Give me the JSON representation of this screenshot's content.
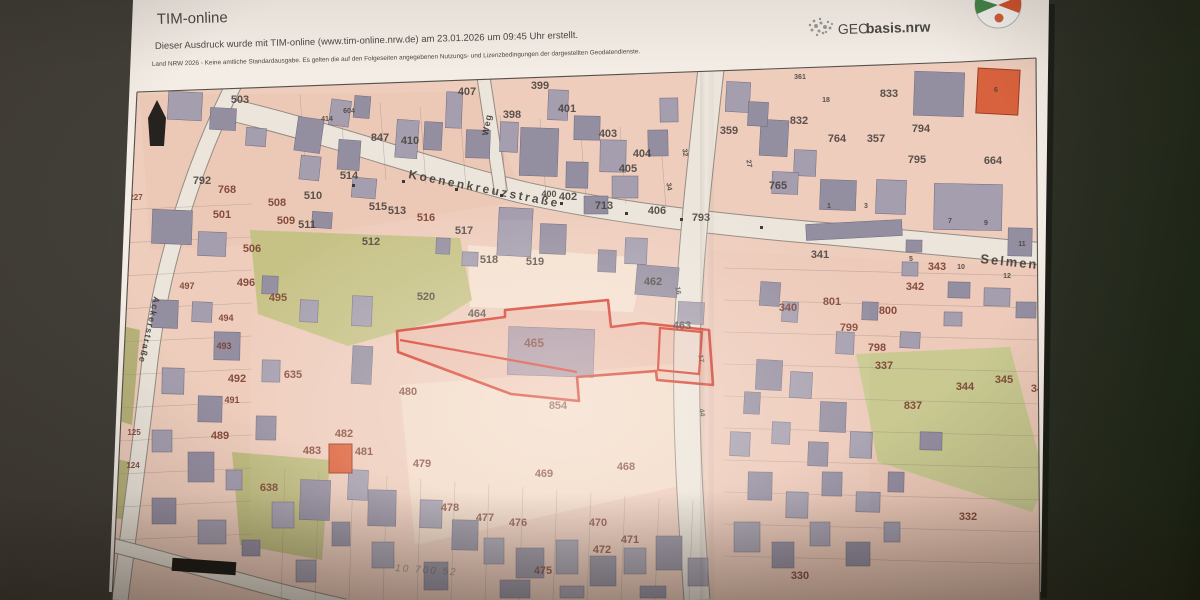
{
  "header": {
    "app_title": "TIM-online",
    "print_note": "Dieser Ausdruck wurde mit TIM-online (www.tim-online.nrw.de) am 23.01.2026 um 09:45 Uhr erstellt.",
    "license_note": "Land NRW 2026 - Keine amtliche Standardausgabe. Es gelten die auf den Folgeseiten angegebenen Nutzungs- und Lizenzbedingungen der dargestellten Geodatendienste.",
    "brand_geo": "GEO",
    "brand_bold": "basis.nrw"
  },
  "map": {
    "type": "cadastral",
    "highlight_parcel": "465",
    "highlight_color": "#e03524",
    "paper_color": "#f0ccba",
    "annotation": {
      "text": "10 700 52",
      "x": 395,
      "y": 571,
      "rot": 4
    },
    "streets": [
      {
        "name": "Koenenkreuzstraße",
        "x": 408,
        "y": 178,
        "rot": 11,
        "size": 12,
        "ls": 2.5
      },
      {
        "name": "Selmen",
        "x": 980,
        "y": 263,
        "rot": 6,
        "size": 13,
        "ls": 2
      },
      {
        "name": "Weg",
        "x": 488,
        "y": 136,
        "rot": -80,
        "size": 9,
        "ls": 1
      },
      {
        "name": "Ackerstraße",
        "x": 154,
        "y": 296,
        "rot": 103,
        "size": 9,
        "ls": 1.5
      }
    ],
    "parcels": [
      {
        "n": "503",
        "x": 240,
        "y": 103,
        "c": "g"
      },
      {
        "n": "407",
        "x": 467,
        "y": 95,
        "c": "g"
      },
      {
        "n": "399",
        "x": 540,
        "y": 89,
        "c": "g"
      },
      {
        "n": "398",
        "x": 512,
        "y": 118,
        "c": "g"
      },
      {
        "n": "401",
        "x": 567,
        "y": 112,
        "c": "g"
      },
      {
        "n": "403",
        "x": 608,
        "y": 137,
        "c": "g"
      },
      {
        "n": "404",
        "x": 642,
        "y": 157,
        "c": "g"
      },
      {
        "n": "405",
        "x": 628,
        "y": 172,
        "c": "g"
      },
      {
        "n": "402",
        "x": 568,
        "y": 200,
        "c": "g"
      },
      {
        "n": "400",
        "x": 549,
        "y": 197,
        "c": "g",
        "s": 9
      },
      {
        "n": "713",
        "x": 604,
        "y": 209,
        "c": "g"
      },
      {
        "n": "406",
        "x": 657,
        "y": 214,
        "c": "g"
      },
      {
        "n": "359",
        "x": 729,
        "y": 134,
        "c": "g"
      },
      {
        "n": "793",
        "x": 701,
        "y": 221,
        "c": "g"
      },
      {
        "n": "765",
        "x": 778,
        "y": 189,
        "c": "g"
      },
      {
        "n": "341",
        "x": 820,
        "y": 258,
        "c": "g"
      },
      {
        "n": "361",
        "x": 800,
        "y": 79,
        "c": "g",
        "s": 7
      },
      {
        "n": "833",
        "x": 889,
        "y": 97,
        "c": "g"
      },
      {
        "n": "832",
        "x": 799,
        "y": 124,
        "c": "g"
      },
      {
        "n": "764",
        "x": 837,
        "y": 142,
        "c": "g"
      },
      {
        "n": "357",
        "x": 876,
        "y": 142,
        "c": "g"
      },
      {
        "n": "794",
        "x": 921,
        "y": 132,
        "c": "g"
      },
      {
        "n": "795",
        "x": 917,
        "y": 163,
        "c": "g"
      },
      {
        "n": "664",
        "x": 993,
        "y": 164,
        "c": "g"
      },
      {
        "n": "343",
        "x": 937,
        "y": 270,
        "c": "m"
      },
      {
        "n": "342",
        "x": 915,
        "y": 290,
        "c": "m"
      },
      {
        "n": "801",
        "x": 832,
        "y": 305,
        "c": "m"
      },
      {
        "n": "800",
        "x": 888,
        "y": 314,
        "c": "m"
      },
      {
        "n": "799",
        "x": 849,
        "y": 331,
        "c": "m"
      },
      {
        "n": "798",
        "x": 877,
        "y": 351,
        "c": "m"
      },
      {
        "n": "337",
        "x": 884,
        "y": 369,
        "c": "m"
      },
      {
        "n": "340",
        "x": 788,
        "y": 311,
        "c": "m"
      },
      {
        "n": "344",
        "x": 965,
        "y": 390,
        "c": "m"
      },
      {
        "n": "345",
        "x": 1004,
        "y": 383,
        "c": "m"
      },
      {
        "n": "34",
        "x": 1037,
        "y": 392,
        "c": "m"
      },
      {
        "n": "837",
        "x": 913,
        "y": 409,
        "c": "m"
      },
      {
        "n": "332",
        "x": 968,
        "y": 520,
        "c": "m"
      },
      {
        "n": "330",
        "x": 800,
        "y": 579,
        "c": "m"
      },
      {
        "n": "847",
        "x": 380,
        "y": 141,
        "c": "g"
      },
      {
        "n": "410",
        "x": 410,
        "y": 144,
        "c": "g"
      },
      {
        "n": "792",
        "x": 202,
        "y": 184,
        "c": "g"
      },
      {
        "n": "768",
        "x": 227,
        "y": 193,
        "c": "m"
      },
      {
        "n": "508",
        "x": 277,
        "y": 206,
        "c": "m"
      },
      {
        "n": "509",
        "x": 286,
        "y": 224,
        "c": "m"
      },
      {
        "n": "510",
        "x": 313,
        "y": 199,
        "c": "g"
      },
      {
        "n": "511",
        "x": 307,
        "y": 228,
        "c": "g"
      },
      {
        "n": "501",
        "x": 222,
        "y": 218,
        "c": "m"
      },
      {
        "n": "506",
        "x": 252,
        "y": 252,
        "c": "m"
      },
      {
        "n": "514",
        "x": 349,
        "y": 179,
        "c": "g"
      },
      {
        "n": "515",
        "x": 378,
        "y": 210,
        "c": "g"
      },
      {
        "n": "513",
        "x": 397,
        "y": 214,
        "c": "g"
      },
      {
        "n": "516",
        "x": 426,
        "y": 221,
        "c": "m"
      },
      {
        "n": "517",
        "x": 464,
        "y": 234,
        "c": "g"
      },
      {
        "n": "512",
        "x": 371,
        "y": 245,
        "c": "g"
      },
      {
        "n": "518",
        "x": 489,
        "y": 263,
        "c": "g"
      },
      {
        "n": "519",
        "x": 535,
        "y": 265,
        "c": "g"
      },
      {
        "n": "520",
        "x": 426,
        "y": 300,
        "c": "g"
      },
      {
        "n": "464",
        "x": 477,
        "y": 317,
        "c": "g"
      },
      {
        "n": "465",
        "x": 534,
        "y": 347,
        "c": "m",
        "s": 12
      },
      {
        "n": "462",
        "x": 653,
        "y": 285,
        "c": "g"
      },
      {
        "n": "463",
        "x": 682,
        "y": 329,
        "c": "g"
      },
      {
        "n": "496",
        "x": 246,
        "y": 286,
        "c": "m"
      },
      {
        "n": "497",
        "x": 187,
        "y": 289,
        "c": "m",
        "s": 9
      },
      {
        "n": "495",
        "x": 278,
        "y": 301,
        "c": "m"
      },
      {
        "n": "494",
        "x": 226,
        "y": 321,
        "c": "m",
        "s": 9
      },
      {
        "n": "493",
        "x": 224,
        "y": 349,
        "c": "m",
        "s": 9
      },
      {
        "n": "492",
        "x": 237,
        "y": 382,
        "c": "m"
      },
      {
        "n": "491",
        "x": 232,
        "y": 403,
        "c": "m",
        "s": 9
      },
      {
        "n": "635",
        "x": 293,
        "y": 378,
        "c": "m"
      },
      {
        "n": "489",
        "x": 220,
        "y": 439,
        "c": "m"
      },
      {
        "n": "638",
        "x": 269,
        "y": 491,
        "c": "m"
      },
      {
        "n": "227",
        "x": 136,
        "y": 200,
        "c": "m",
        "s": 8
      },
      {
        "n": "125",
        "x": 134,
        "y": 435,
        "c": "m",
        "s": 8
      },
      {
        "n": "124",
        "x": 133,
        "y": 468,
        "c": "m",
        "s": 8
      },
      {
        "n": "480",
        "x": 408,
        "y": 395,
        "c": "m"
      },
      {
        "n": "854",
        "x": 558,
        "y": 409,
        "c": "m"
      },
      {
        "n": "479",
        "x": 422,
        "y": 467,
        "c": "m"
      },
      {
        "n": "482",
        "x": 344,
        "y": 437,
        "c": "m"
      },
      {
        "n": "483",
        "x": 312,
        "y": 454,
        "c": "m"
      },
      {
        "n": "481",
        "x": 364,
        "y": 455,
        "c": "m"
      },
      {
        "n": "469",
        "x": 544,
        "y": 477,
        "c": "m"
      },
      {
        "n": "468",
        "x": 626,
        "y": 470,
        "c": "m"
      },
      {
        "n": "478",
        "x": 450,
        "y": 511,
        "c": "m"
      },
      {
        "n": "477",
        "x": 485,
        "y": 521,
        "c": "m"
      },
      {
        "n": "476",
        "x": 518,
        "y": 526,
        "c": "m"
      },
      {
        "n": "470",
        "x": 598,
        "y": 526,
        "c": "m"
      },
      {
        "n": "471",
        "x": 630,
        "y": 543,
        "c": "m"
      },
      {
        "n": "472",
        "x": 602,
        "y": 553,
        "c": "m"
      },
      {
        "n": "475",
        "x": 543,
        "y": 574,
        "c": "m"
      },
      {
        "n": "18",
        "x": 826,
        "y": 102,
        "c": "g",
        "s": 7
      },
      {
        "n": "1",
        "x": 829,
        "y": 208,
        "c": "g",
        "s": 7
      },
      {
        "n": "3",
        "x": 866,
        "y": 208,
        "c": "g",
        "s": 7
      },
      {
        "n": "7",
        "x": 950,
        "y": 223,
        "c": "g",
        "s": 7
      },
      {
        "n": "9",
        "x": 986,
        "y": 225,
        "c": "g",
        "s": 7
      },
      {
        "n": "11",
        "x": 1022,
        "y": 246,
        "c": "g",
        "s": 7
      },
      {
        "n": "5",
        "x": 911,
        "y": 261,
        "c": "g",
        "s": 7
      },
      {
        "n": "10",
        "x": 961,
        "y": 269,
        "c": "g",
        "s": 7
      },
      {
        "n": "12",
        "x": 1007,
        "y": 278,
        "c": "g",
        "s": 7
      },
      {
        "n": "414",
        "x": 327,
        "y": 121,
        "c": "g",
        "s": 7
      },
      {
        "n": "604",
        "x": 349,
        "y": 113,
        "c": "g",
        "s": 7
      },
      {
        "n": "6",
        "x": 996,
        "y": 92,
        "c": "g",
        "s": 7
      },
      {
        "n": "32",
        "x": 683,
        "y": 153,
        "c": "g",
        "s": 7,
        "r": 80
      },
      {
        "n": "34",
        "x": 667,
        "y": 187,
        "c": "g",
        "s": 7,
        "r": 80
      },
      {
        "n": "27",
        "x": 747,
        "y": 164,
        "c": "g",
        "s": 7,
        "r": 80
      },
      {
        "n": "16",
        "x": 676,
        "y": 291,
        "c": "g",
        "s": 7,
        "r": 80
      },
      {
        "n": "17",
        "x": 699,
        "y": 359,
        "c": "g",
        "s": 7,
        "r": 80
      },
      {
        "n": "44",
        "x": 700,
        "y": 413,
        "c": "g",
        "s": 7,
        "r": 80
      }
    ]
  }
}
